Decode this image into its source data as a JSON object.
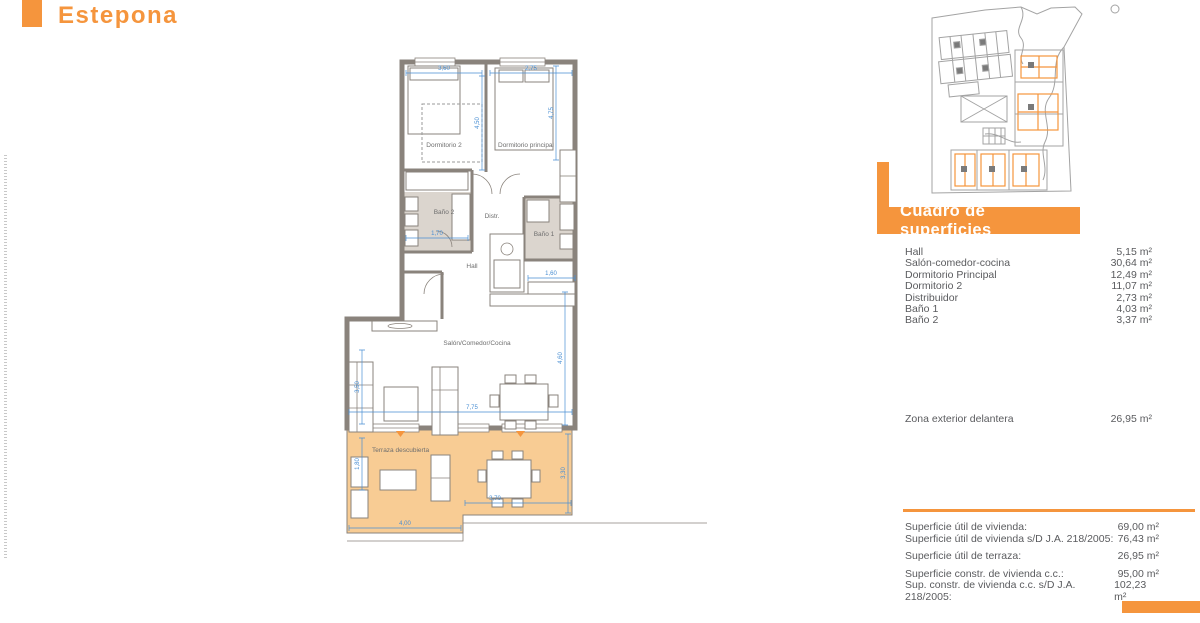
{
  "header": {
    "project_location": "Estepona"
  },
  "colors": {
    "accent": "#F5953D",
    "terrace_fill": "#F8CC94",
    "dimension_blue": "#4A8FD3",
    "wall_gray": "#8A837C",
    "text_gray": "#58595B"
  },
  "floor_plan": {
    "room_labels": {
      "dormitorio_2": "Dormitorio 2",
      "dormitorio_principal": "Dormitorio principal",
      "bano_2": "Baño 2",
      "distribuidor": "Distr.",
      "bano_1": "Baño 1",
      "hall": "Hall",
      "salon": "Salón/Comedor/Cocina",
      "terraza": "Terraza descubierta"
    },
    "dimensions": {
      "dorm2_width": "3,60",
      "dormp_width": "2,75",
      "dorm2_depth": "4,50",
      "dormp_depth": "4,75",
      "bano2_width": "1,70",
      "cocina_width": "1,60",
      "salon_left_depth": "3,50",
      "salon_width": "7,75",
      "salon_right_depth": "4,60",
      "terraza_left_depth": "1,80",
      "terraza_right_depth": "3,30",
      "terraza_right_width": "3,70",
      "terraza_left_width": "4,00"
    }
  },
  "surface_table": {
    "title": "Cuadro de superficies",
    "rows": [
      {
        "label": "Hall",
        "value": "5,15 m²"
      },
      {
        "label": "Salón-comedor-cocina",
        "value": "30,64 m²"
      },
      {
        "label": "Dormitorio Principal",
        "value": "12,49 m²"
      },
      {
        "label": "Dormitorio 2",
        "value": "11,07 m²"
      },
      {
        "label": "Distribuidor",
        "value": "2,73 m²"
      },
      {
        "label": "Baño 1",
        "value": "4,03 m²"
      },
      {
        "label": "Baño 2",
        "value": "3,37 m²"
      }
    ],
    "exterior": {
      "label": "Zona exterior delantera",
      "value": "26,95 m²"
    }
  },
  "summary": {
    "rows": [
      {
        "label": "Superficie útil de vivienda:",
        "value": "69,00 m²"
      },
      {
        "label": "Superficie útil de vivienda s/D J.A. 218/2005:",
        "value": "76,43 m²"
      },
      {
        "label": "Superficie útil de terraza:",
        "value": "26,95 m²"
      },
      {
        "label": "Superficie constr. de vivienda c.c.:",
        "value": "95,00 m²"
      },
      {
        "label": "Sup. constr. de vivienda c.c. s/D J.A. 218/2005:",
        "value": "102,23 m²"
      }
    ]
  }
}
